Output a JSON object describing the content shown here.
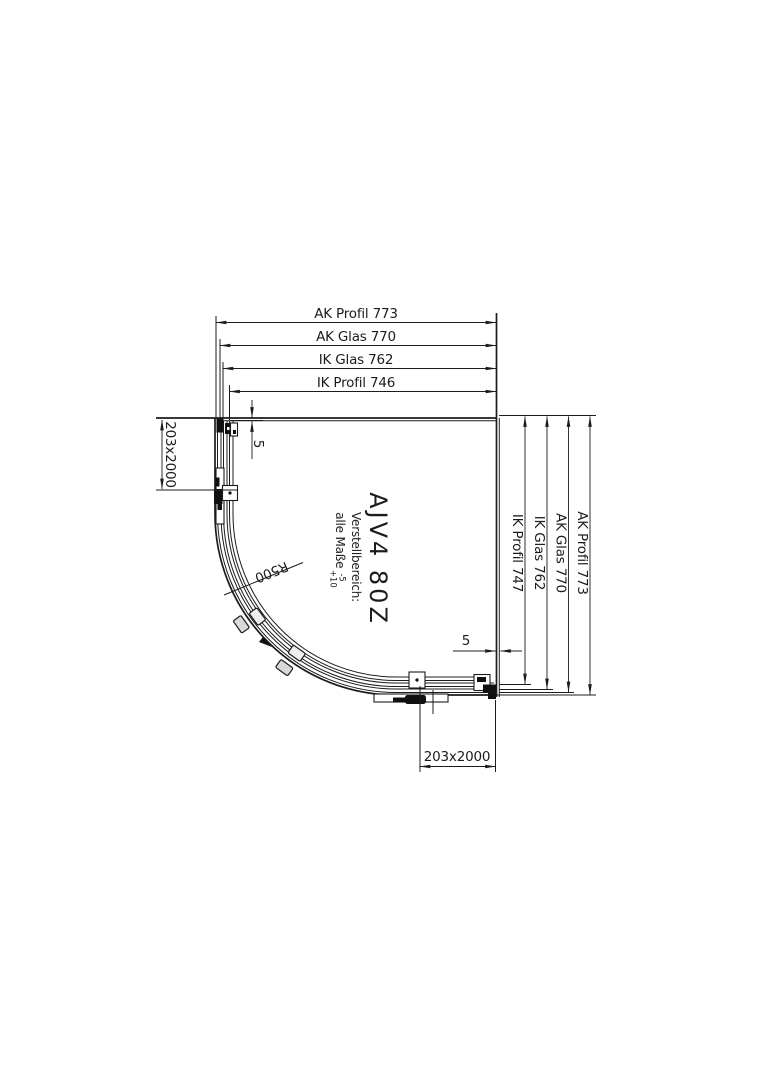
{
  "drawing": {
    "type_label": "quadrant-shower-enclosure-plan",
    "model": "AJV4 80Z",
    "note_title": "Verstellbereich:",
    "note_body": "alle Maße",
    "note_tol_upper": "-5",
    "note_tol_lower": "+10",
    "radius_label": "R500",
    "top_dims": [
      "AK Profil 773",
      "AK Glas 770",
      "IK Glas 762",
      "IK Profil 746"
    ],
    "right_dims": [
      "IK Profil 747",
      "IK Glas 762",
      "AK Glas 770",
      "AK Profil 773"
    ],
    "left_panel_dim": "203x2000",
    "bottom_panel_dim": "203x2000",
    "gap_top": "5",
    "gap_right": "5"
  },
  "colors": {
    "line": "#1c1c1c",
    "background": "#ffffff"
  }
}
